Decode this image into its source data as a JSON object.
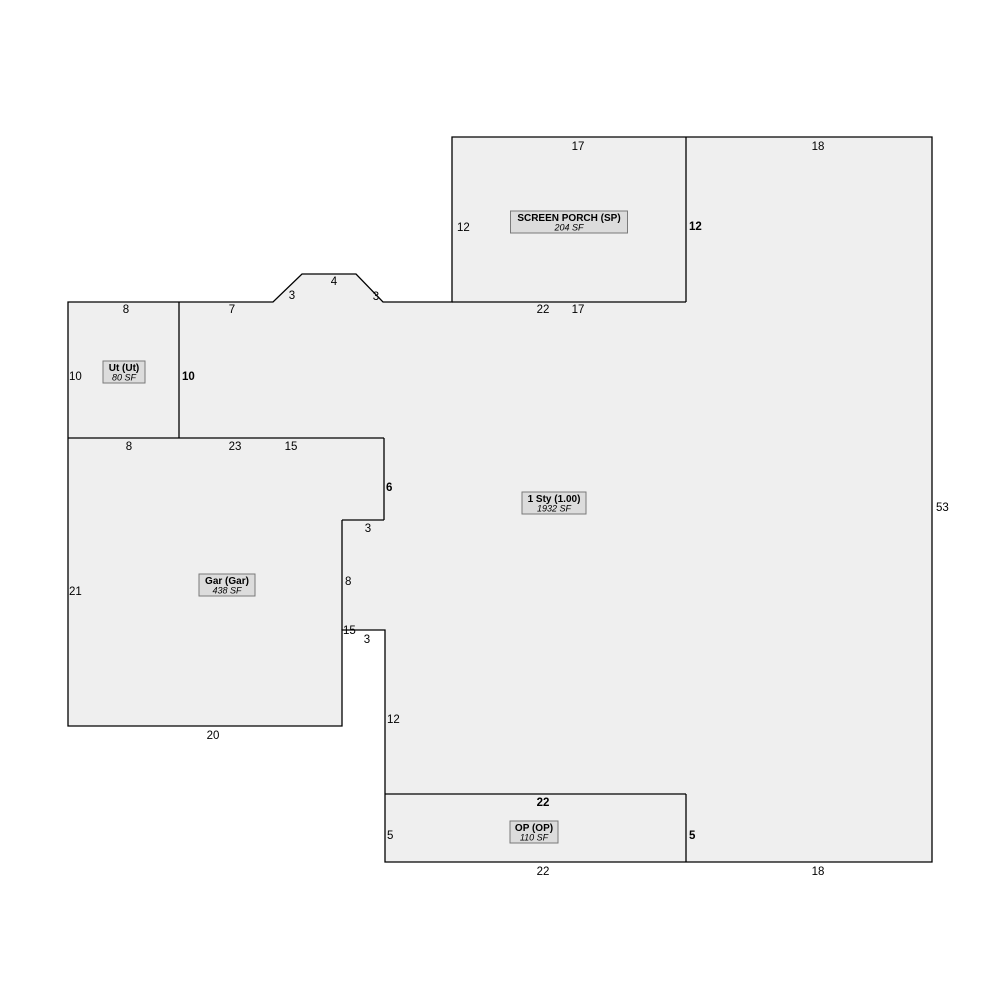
{
  "sketch": {
    "title": "property-sketch-floor-plan",
    "colors": {
      "page_background": "#ffffff",
      "footprint_fill": "#efefef",
      "outline_stroke": "#000000",
      "label_box_fill": "#dcdcdc",
      "label_box_border": "#7a7a7a",
      "text_color": "#000000"
    },
    "outline_points": "68,302 273,302 302,274 356,274 383,302 452,302 452,137 932,137 932,862 385,862 385,630 342,630 342,726 68,726",
    "inner_lines": [
      {
        "name": "porch-bottom-divider",
        "x1": 452,
        "y1": 302,
        "x2": 686,
        "y2": 302
      },
      {
        "name": "porch-right-divider",
        "x1": 686,
        "y1": 137,
        "x2": 686,
        "y2": 302
      },
      {
        "name": "ut-right-divider",
        "x1": 179,
        "y1": 302,
        "x2": 179,
        "y2": 438
      },
      {
        "name": "garage-top-divider",
        "x1": 68,
        "y1": 438,
        "x2": 384,
        "y2": 438
      },
      {
        "name": "garage-step-vert-1",
        "x1": 384,
        "y1": 438,
        "x2": 384,
        "y2": 520
      },
      {
        "name": "garage-step-horiz-1",
        "x1": 342,
        "y1": 520,
        "x2": 384,
        "y2": 520
      },
      {
        "name": "garage-step-vert-2",
        "x1": 342,
        "y1": 520,
        "x2": 342,
        "y2": 630
      },
      {
        "name": "op-top-divider",
        "x1": 385,
        "y1": 794,
        "x2": 686,
        "y2": 794
      },
      {
        "name": "op-right-divider",
        "x1": 686,
        "y1": 794,
        "x2": 686,
        "y2": 862
      }
    ],
    "areas": [
      {
        "name": "SCREEN PORCH (SP)",
        "sf": "204 SF",
        "cx": 569,
        "cy": 222,
        "w": 117,
        "h": 22
      },
      {
        "name": "Ut (Ut)",
        "sf": "80 SF",
        "cx": 124,
        "cy": 372,
        "w": 42,
        "h": 22
      },
      {
        "name": "Gar (Gar)",
        "sf": "438 SF",
        "cx": 227,
        "cy": 585,
        "w": 56,
        "h": 22
      },
      {
        "name": "1 Sty (1.00)",
        "sf": "1932 SF",
        "cx": 554,
        "cy": 503,
        "w": 64,
        "h": 22
      },
      {
        "name": "OP (OP)",
        "sf": "110 SF",
        "cx": 534,
        "cy": 832,
        "w": 48,
        "h": 22
      }
    ],
    "dimensions": [
      {
        "text": "17",
        "x": 578,
        "y": 150,
        "bold": false,
        "anchor": "middle"
      },
      {
        "text": "18",
        "x": 818,
        "y": 150,
        "bold": false,
        "anchor": "middle"
      },
      {
        "text": "12",
        "x": 457,
        "y": 231,
        "bold": false,
        "anchor": "start"
      },
      {
        "text": "12",
        "x": 689,
        "y": 230,
        "bold": true,
        "anchor": "start"
      },
      {
        "text": "22",
        "x": 543,
        "y": 313,
        "bold": false,
        "anchor": "middle"
      },
      {
        "text": "17",
        "x": 578,
        "y": 313,
        "bold": false,
        "anchor": "middle"
      },
      {
        "text": "8",
        "x": 126,
        "y": 313,
        "bold": false,
        "anchor": "middle"
      },
      {
        "text": "7",
        "x": 232,
        "y": 313,
        "bold": false,
        "anchor": "middle"
      },
      {
        "text": "3",
        "x": 292,
        "y": 299,
        "bold": false,
        "anchor": "middle"
      },
      {
        "text": "4",
        "x": 334,
        "y": 285,
        "bold": false,
        "anchor": "middle"
      },
      {
        "text": "3",
        "x": 376,
        "y": 300,
        "bold": false,
        "anchor": "middle"
      },
      {
        "text": "10",
        "x": 69,
        "y": 380,
        "bold": false,
        "anchor": "start"
      },
      {
        "text": "10",
        "x": 182,
        "y": 380,
        "bold": true,
        "anchor": "start"
      },
      {
        "text": "8",
        "x": 129,
        "y": 450,
        "bold": false,
        "anchor": "middle"
      },
      {
        "text": "23",
        "x": 235,
        "y": 450,
        "bold": false,
        "anchor": "middle"
      },
      {
        "text": "15",
        "x": 291,
        "y": 450,
        "bold": false,
        "anchor": "middle"
      },
      {
        "text": "6",
        "x": 386,
        "y": 491,
        "bold": true,
        "anchor": "start"
      },
      {
        "text": "3",
        "x": 368,
        "y": 532,
        "bold": false,
        "anchor": "middle"
      },
      {
        "text": "8",
        "x": 345,
        "y": 585,
        "bold": false,
        "anchor": "start"
      },
      {
        "text": "21",
        "x": 69,
        "y": 595,
        "bold": false,
        "anchor": "start"
      },
      {
        "text": "15",
        "x": 343,
        "y": 634,
        "bold": false,
        "anchor": "start"
      },
      {
        "text": "3",
        "x": 367,
        "y": 643,
        "bold": false,
        "anchor": "middle"
      },
      {
        "text": "12",
        "x": 387,
        "y": 723,
        "bold": false,
        "anchor": "start"
      },
      {
        "text": "20",
        "x": 213,
        "y": 739,
        "bold": false,
        "anchor": "middle"
      },
      {
        "text": "53",
        "x": 936,
        "y": 511,
        "bold": false,
        "anchor": "start"
      },
      {
        "text": "22",
        "x": 543,
        "y": 806,
        "bold": true,
        "anchor": "middle"
      },
      {
        "text": "5",
        "x": 387,
        "y": 839,
        "bold": false,
        "anchor": "start"
      },
      {
        "text": "5",
        "x": 689,
        "y": 839,
        "bold": true,
        "anchor": "start"
      },
      {
        "text": "22",
        "x": 543,
        "y": 875,
        "bold": false,
        "anchor": "middle"
      },
      {
        "text": "18",
        "x": 818,
        "y": 875,
        "bold": false,
        "anchor": "middle"
      }
    ]
  }
}
